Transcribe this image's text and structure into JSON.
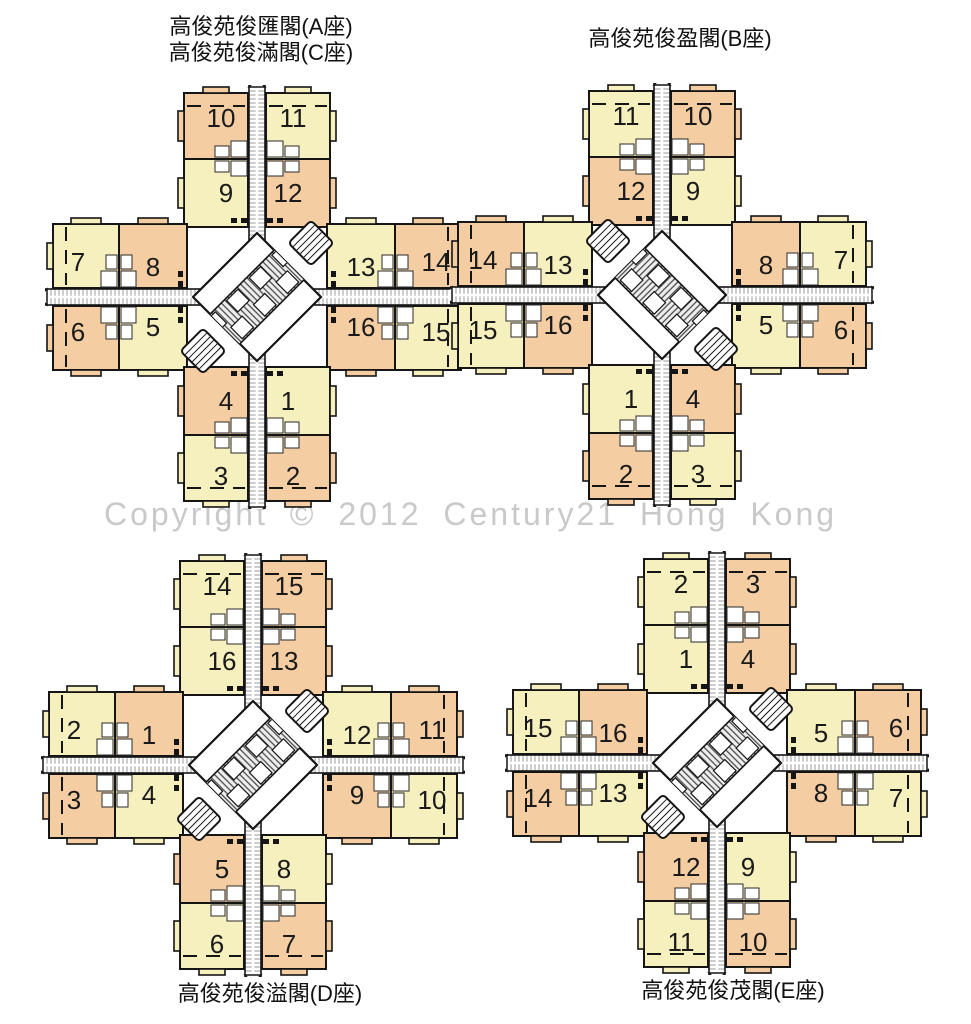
{
  "watermark": "Copyright © 2012 Century21 Hong Kong",
  "palette": {
    "yellow": "#f5f0bd",
    "orange": "#f4cda3",
    "wall": "#151515",
    "label": "#1a1a1a",
    "corridor_rung": "#9b9b9b",
    "band_stripe": "#4a4a4a",
    "band_bg": "#efefef",
    "watermark_color": "#c9c9c9",
    "fixture_stroke": "#2a2a2a"
  },
  "plans": [
    {
      "key": "ac",
      "title_lines": [
        "高俊苑俊匯閣(A座)",
        "高俊苑俊滿閣(C座)"
      ],
      "mirrored": false,
      "center": {
        "x": 257,
        "y": 297
      },
      "wings": {
        "top": {
          "outer_left": {
            "no": "10",
            "color": "orange"
          },
          "outer_right": {
            "no": "11",
            "color": "yellow"
          },
          "inner_left": {
            "no": "9",
            "color": "yellow"
          },
          "inner_right": {
            "no": "12",
            "color": "orange"
          }
        },
        "left": {
          "outer_top": {
            "no": "7",
            "color": "yellow"
          },
          "inner_top": {
            "no": "8",
            "color": "orange"
          },
          "outer_bottom": {
            "no": "6",
            "color": "orange"
          },
          "inner_bottom": {
            "no": "5",
            "color": "yellow"
          }
        },
        "right": {
          "inner_top": {
            "no": "13",
            "color": "yellow"
          },
          "outer_top": {
            "no": "14",
            "color": "orange"
          },
          "inner_bottom": {
            "no": "16",
            "color": "orange"
          },
          "outer_bottom": {
            "no": "15",
            "color": "yellow"
          }
        },
        "bottom": {
          "inner_left": {
            "no": "4",
            "color": "orange"
          },
          "inner_right": {
            "no": "1",
            "color": "yellow"
          },
          "outer_left": {
            "no": "3",
            "color": "yellow"
          },
          "outer_right": {
            "no": "2",
            "color": "orange"
          }
        }
      }
    },
    {
      "key": "b",
      "title_lines": [
        "高俊苑俊盈閣(B座)"
      ],
      "mirrored": true,
      "center": {
        "x": 662,
        "y": 295
      },
      "wings": {
        "top": {
          "outer_left": {
            "no": "11",
            "color": "yellow"
          },
          "outer_right": {
            "no": "10",
            "color": "orange"
          },
          "inner_left": {
            "no": "12",
            "color": "orange"
          },
          "inner_right": {
            "no": "9",
            "color": "yellow"
          }
        },
        "left": {
          "outer_top": {
            "no": "14",
            "color": "orange"
          },
          "inner_top": {
            "no": "13",
            "color": "yellow"
          },
          "outer_bottom": {
            "no": "15",
            "color": "yellow"
          },
          "inner_bottom": {
            "no": "16",
            "color": "orange"
          }
        },
        "right": {
          "inner_top": {
            "no": "8",
            "color": "orange"
          },
          "outer_top": {
            "no": "7",
            "color": "yellow"
          },
          "inner_bottom": {
            "no": "5",
            "color": "yellow"
          },
          "outer_bottom": {
            "no": "6",
            "color": "orange"
          }
        },
        "bottom": {
          "inner_left": {
            "no": "1",
            "color": "yellow"
          },
          "inner_right": {
            "no": "4",
            "color": "orange"
          },
          "outer_left": {
            "no": "2",
            "color": "orange"
          },
          "outer_right": {
            "no": "3",
            "color": "yellow"
          }
        }
      }
    },
    {
      "key": "d",
      "title_lines": [
        "高俊苑俊溢閣(D座)"
      ],
      "mirrored": false,
      "center": {
        "x": 253,
        "y": 765
      },
      "wings": {
        "top": {
          "outer_left": {
            "no": "14",
            "color": "yellow"
          },
          "outer_right": {
            "no": "15",
            "color": "orange"
          },
          "inner_left": {
            "no": "16",
            "color": "yellow"
          },
          "inner_right": {
            "no": "13",
            "color": "orange"
          }
        },
        "left": {
          "outer_top": {
            "no": "2",
            "color": "yellow"
          },
          "inner_top": {
            "no": "1",
            "color": "orange"
          },
          "outer_bottom": {
            "no": "3",
            "color": "orange"
          },
          "inner_bottom": {
            "no": "4",
            "color": "yellow"
          }
        },
        "right": {
          "inner_top": {
            "no": "12",
            "color": "yellow"
          },
          "outer_top": {
            "no": "11",
            "color": "orange"
          },
          "inner_bottom": {
            "no": "9",
            "color": "orange"
          },
          "outer_bottom": {
            "no": "10",
            "color": "yellow"
          }
        },
        "bottom": {
          "inner_left": {
            "no": "5",
            "color": "orange"
          },
          "inner_right": {
            "no": "8",
            "color": "yellow"
          },
          "outer_left": {
            "no": "6",
            "color": "yellow"
          },
          "outer_right": {
            "no": "7",
            "color": "orange"
          }
        }
      }
    },
    {
      "key": "e",
      "title_lines": [
        "高俊苑俊茂閣(E座)"
      ],
      "mirrored": false,
      "center": {
        "x": 717,
        "y": 763
      },
      "wings": {
        "top": {
          "outer_left": {
            "no": "2",
            "color": "yellow"
          },
          "outer_right": {
            "no": "3",
            "color": "orange"
          },
          "inner_left": {
            "no": "1",
            "color": "yellow"
          },
          "inner_right": {
            "no": "4",
            "color": "orange"
          }
        },
        "left": {
          "outer_top": {
            "no": "15",
            "color": "yellow"
          },
          "inner_top": {
            "no": "16",
            "color": "orange"
          },
          "outer_bottom": {
            "no": "14",
            "color": "orange"
          },
          "inner_bottom": {
            "no": "13",
            "color": "yellow"
          }
        },
        "right": {
          "inner_top": {
            "no": "5",
            "color": "yellow"
          },
          "outer_top": {
            "no": "6",
            "color": "orange"
          },
          "inner_bottom": {
            "no": "8",
            "color": "orange"
          },
          "outer_bottom": {
            "no": "7",
            "color": "yellow"
          }
        },
        "bottom": {
          "inner_left": {
            "no": "12",
            "color": "orange"
          },
          "inner_right": {
            "no": "9",
            "color": "yellow"
          },
          "outer_left": {
            "no": "11",
            "color": "yellow"
          },
          "outer_right": {
            "no": "10",
            "color": "orange"
          }
        }
      }
    }
  ]
}
